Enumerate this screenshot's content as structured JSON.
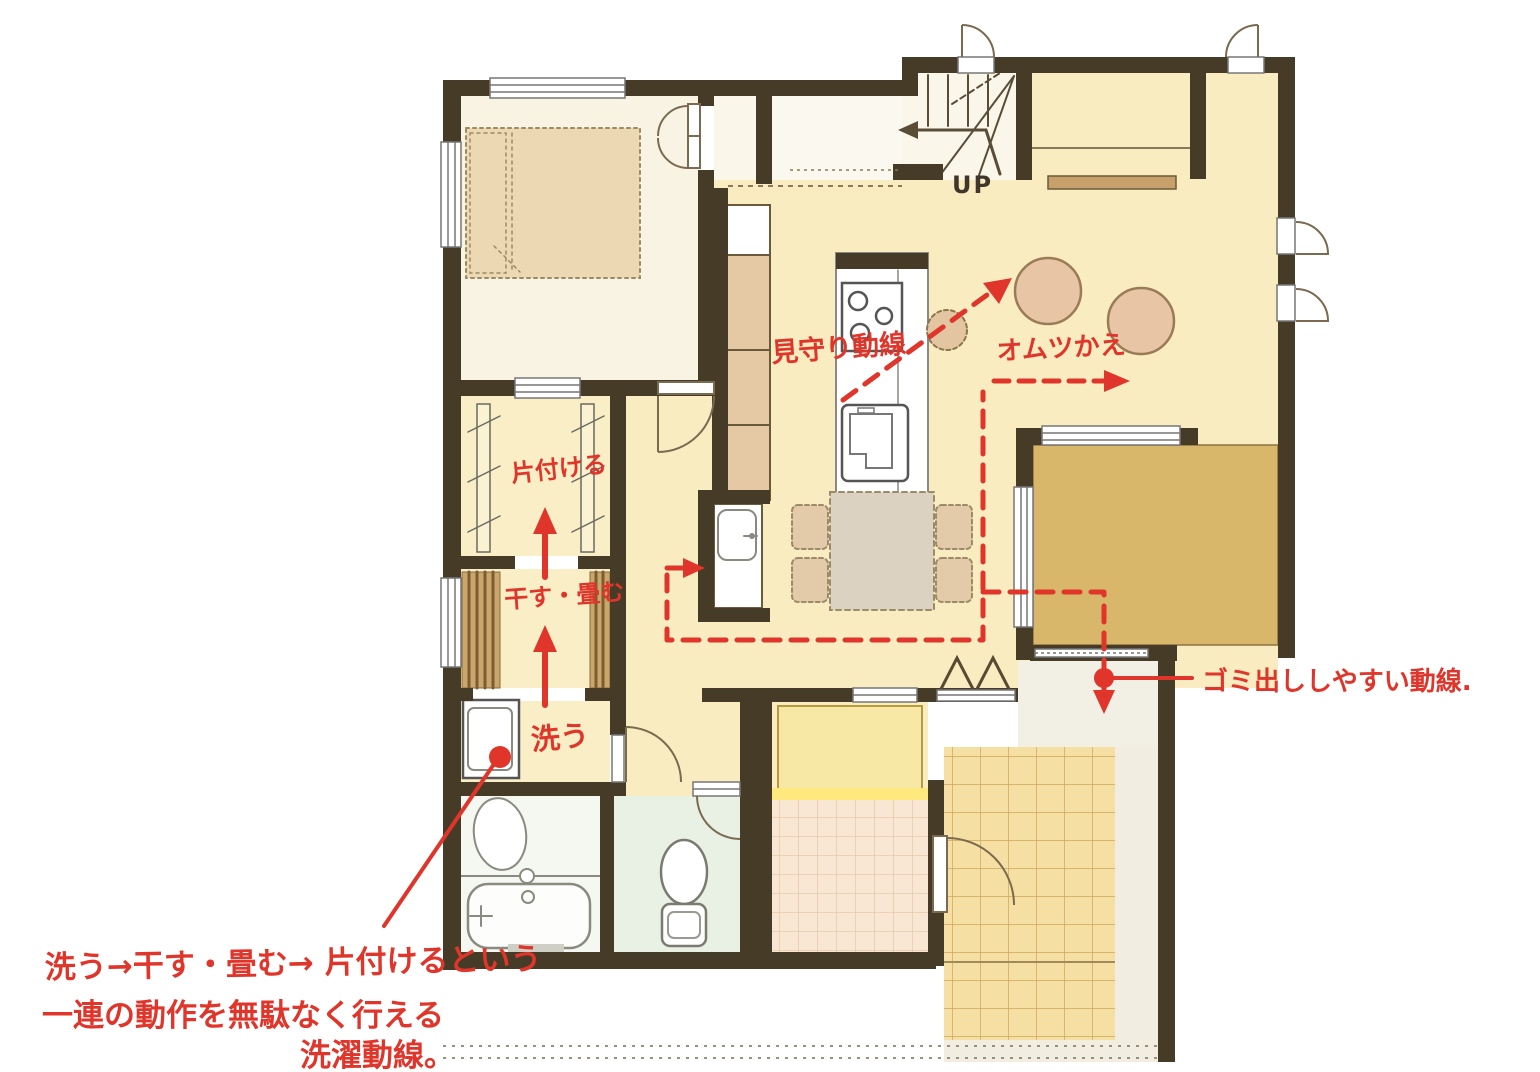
{
  "annotations": {
    "accent_color": "#df352a",
    "mimamori_label": "見守り動線",
    "omutsu_label": "オムツかえ",
    "katazukeru_label": "片付ける",
    "hosu_tatamu_label": "干す・畳む",
    "arau_label": "洗う",
    "gomi_label": "ゴミ出ししやすい動線.",
    "laundry_note_line1": "洗う→干す・畳む→ 片付けるという",
    "laundry_note_line2": "一連の動作を無駄なく行える",
    "laundry_note_line3": "洗濯動線。"
  },
  "plan": {
    "stairs_up_label": "UP",
    "colors": {
      "wall": "#463b27",
      "floor_main": "#f9ecc1",
      "floor_bedroom": "#f8f3e2",
      "floor_laundry": "#faeec6",
      "floor_tatami": "#d8b76a",
      "floor_hall": "#f2efe5",
      "floor_bath": "#f5f8f0",
      "floor_toilet": "#e9f0e4",
      "tile_entrance": "#f6dfa3",
      "tile_shoe": "#f9e7d3",
      "porch": "#f1ede1",
      "furniture_tan": "#e7c5a5",
      "storage_yellow": "#f8e8a6"
    }
  }
}
